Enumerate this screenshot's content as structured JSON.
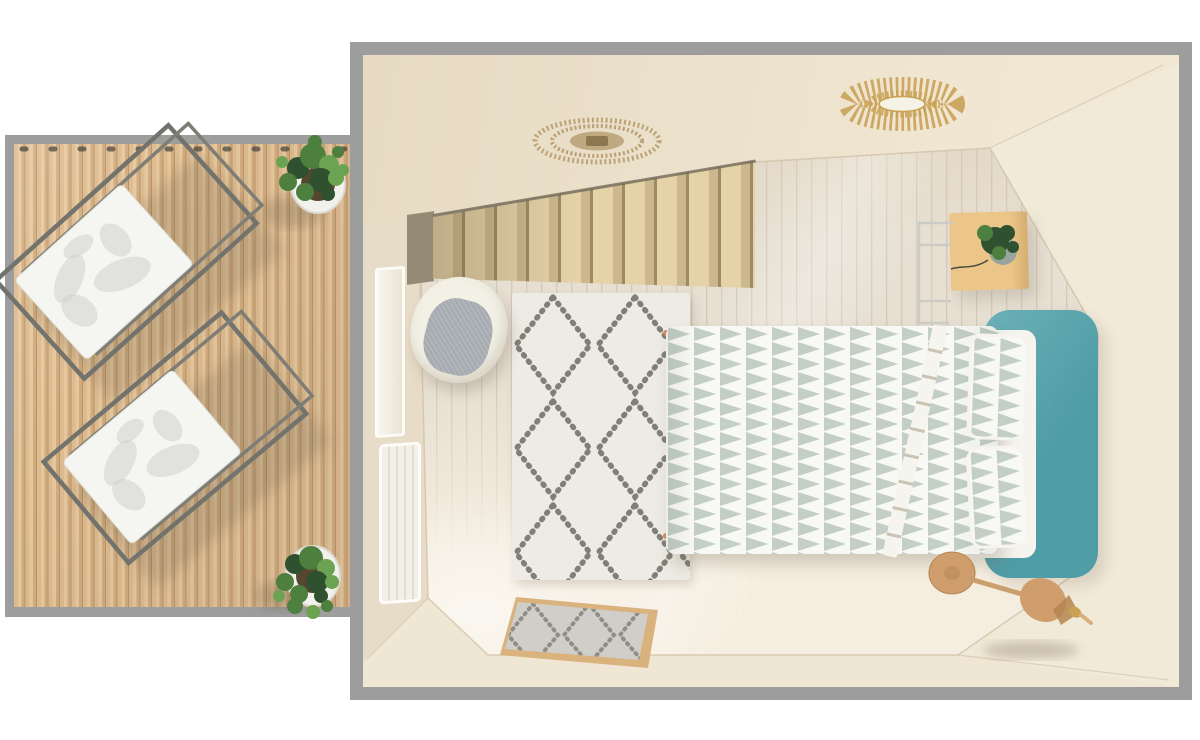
{
  "meta": {
    "type": "3d-floorplan-render",
    "description": "Top-down 3D rendered floor plan of a small bedroom with a staircase, double bed with teal headboard, berber rug, and an adjacent outdoor wooden deck terrace with two lounge chairs and potted plants",
    "width_px": 1200,
    "height_px": 740
  },
  "colors": {
    "bg": "#ffffff",
    "border_grey": "#9d9d9d",
    "deck_a": "#debb90",
    "deck_b": "#d2ab7d",
    "deck_light": "#e6c89e",
    "deck_line": "#b7946a",
    "wall_base": "#e9decb",
    "ceiling_a": "#e6dac2",
    "ceiling_b": "#f1e7d3",
    "wall_right": "#f2ead9",
    "wall_bottom": "#efe6d3",
    "wall_line": "#cfc0a5",
    "floor_a": "#e6dfd2",
    "floor_line": "#d5cabb",
    "stair_a": "#e6d2a8",
    "stair_b": "#cdb88d",
    "stair_line": "#9d8a66",
    "stair_dark": "#958a76",
    "stair_edge": "#6a6251",
    "rug_base": "#edebe3",
    "rug_ink": "#6f6d65",
    "mat_border": "#d9b27e",
    "mat_base": "#cfcec8",
    "mat_ink": "#8a877c",
    "duvet_white": "#f8f8f4",
    "sage": "#c3cfc4",
    "sheet": "#f6f4ee",
    "teal": "#4f9da6",
    "teal_light": "#6db0b8",
    "table_wood": "#ecc689",
    "plant_dark": "#2f5130",
    "plant_mid": "#4d7f3e",
    "plant_light": "#6ca352",
    "pot_white": "#f2f1ed",
    "soil": "#56452f",
    "chrome": "#9aa49e",
    "chrome_light": "#e8ece9",
    "chair_shell": "#f3f0e5",
    "chair_cushion": "#a5aab0",
    "cork": "#cf9e6c",
    "cork_dark": "#b5854f",
    "gold": "#c8a155",
    "rattan": "#b99f74",
    "rattan_dark": "#8d7751",
    "wire": "#c9c9c4",
    "leaf": "#d4d4cf",
    "frame_metal": "#73736d",
    "fabric_white": "#f5f5f2",
    "tassel": "#d78a63"
  },
  "scene": {
    "deck": {
      "label": "Wooden deck terrace",
      "objects": [
        {
          "id": "lounge-chair-1",
          "label": "Folding lounge chair with palm-leaf print fabric"
        },
        {
          "id": "lounge-chair-2",
          "label": "Folding lounge chair with palm-leaf print fabric"
        },
        {
          "id": "potted-plant-top",
          "label": "Green potted plant in white planter (top of deck)"
        },
        {
          "id": "potted-plant-bottom",
          "label": "Green potted plant in white planter (bottom of deck)"
        }
      ]
    },
    "room": {
      "label": "Bedroom",
      "objects": [
        {
          "id": "staircase",
          "label": "Wooden staircase rising along the top wall"
        },
        {
          "id": "woven-ceiling-light",
          "label": "Round woven rattan ceiling light"
        },
        {
          "id": "sunburst-ceiling-light",
          "label": "Gold sunburst ceiling light"
        },
        {
          "id": "bed",
          "label": "Bed with sage triangle-pattern duvet, two pillows and teal headboard"
        },
        {
          "id": "berber-rug",
          "label": "Cream berber rug with dark diamond lattice"
        },
        {
          "id": "doormat",
          "label": "Small diamond-pattern doormat with wooden frame"
        },
        {
          "id": "shell-chair",
          "label": "White shell chair with grey cushion"
        },
        {
          "id": "side-table",
          "label": "Wooden bedside table with plant in chrome pot"
        },
        {
          "id": "window",
          "label": "Window on left wall"
        },
        {
          "id": "radiator",
          "label": "Radiator on left wall"
        },
        {
          "id": "cork-stool",
          "label": "Round cork stool at foot of bed"
        },
        {
          "id": "cork-pendant-lamp",
          "label": "Cork pendant lamp resting against the wall"
        }
      ]
    }
  }
}
